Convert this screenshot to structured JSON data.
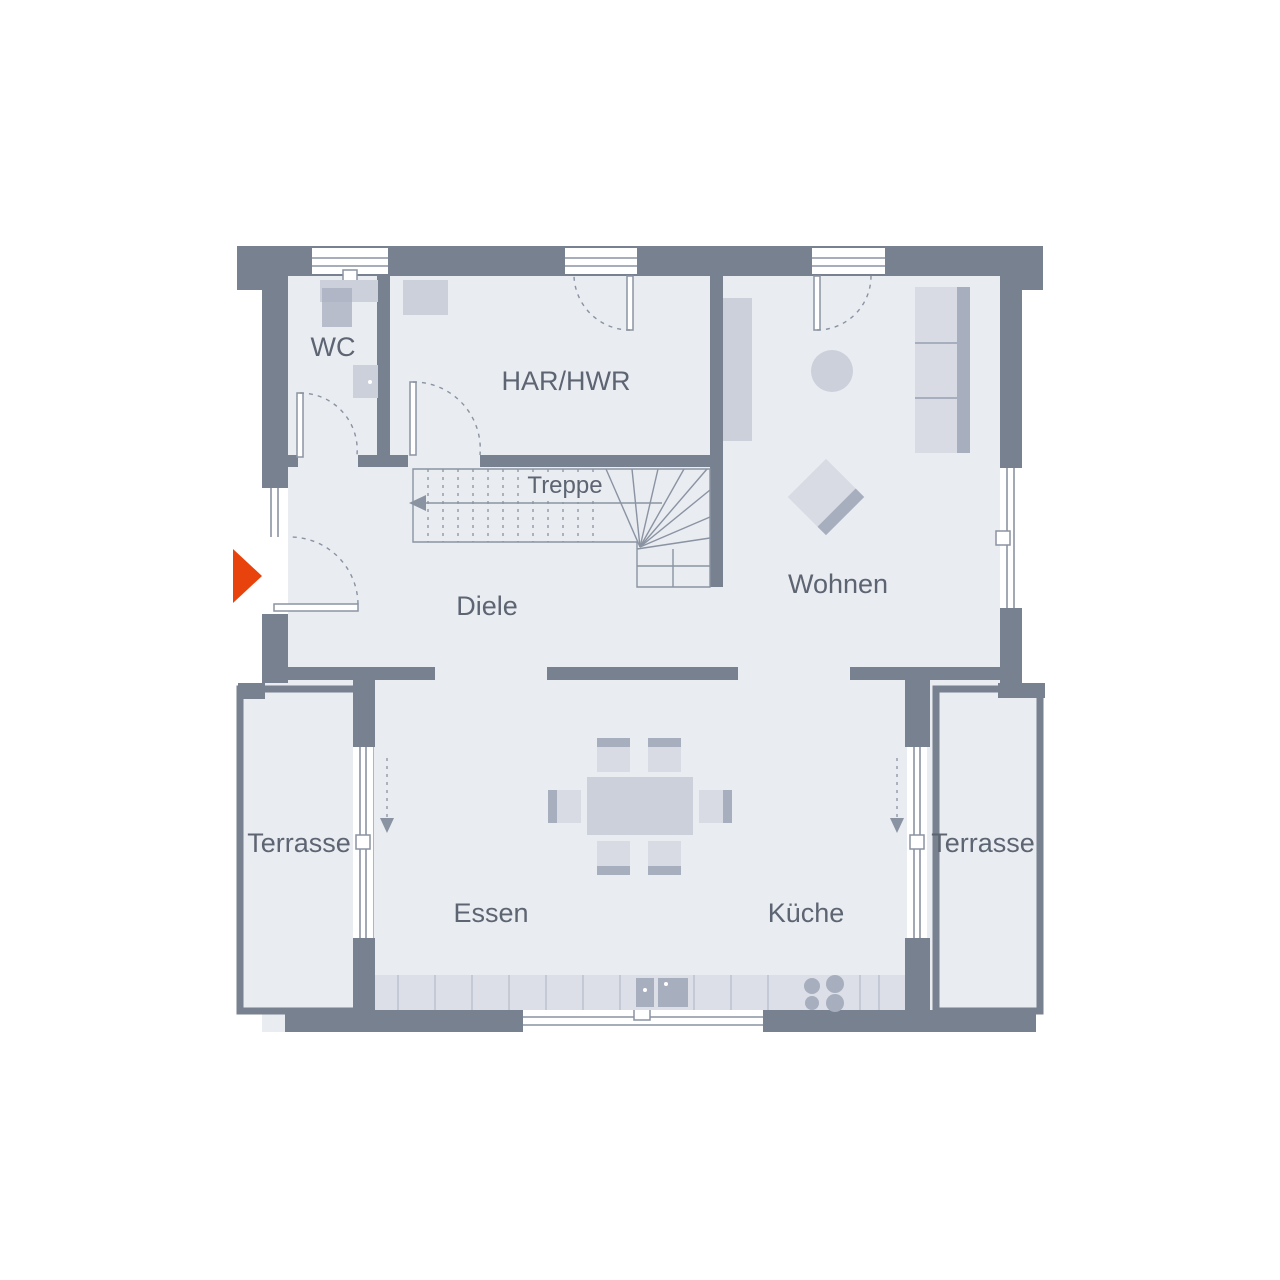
{
  "plan": {
    "title": "Grundriss Erdgeschoss",
    "labels": {
      "wc": "WC",
      "har_hwr": "HAR/HWR",
      "treppe": "Treppe",
      "diele": "Diele",
      "wohnen": "Wohnen",
      "terrasse_left": "Terrasse",
      "terrasse_right": "Terrasse",
      "essen": "Essen",
      "kueche": "Küche"
    },
    "colors": {
      "background": "#FFFFFF",
      "wall": "#77818F",
      "floor": "#E9ECF1",
      "line": "#8A93A2",
      "furniture_light": "#D8DBE4",
      "furniture_mid": "#CBD0DB",
      "furniture_dark": "#A7AEBD",
      "counter": "#DCDFE7",
      "counter_line": "#BDC3CF",
      "text": "#5D6472",
      "entrance_arrow": "#E9430D"
    }
  }
}
